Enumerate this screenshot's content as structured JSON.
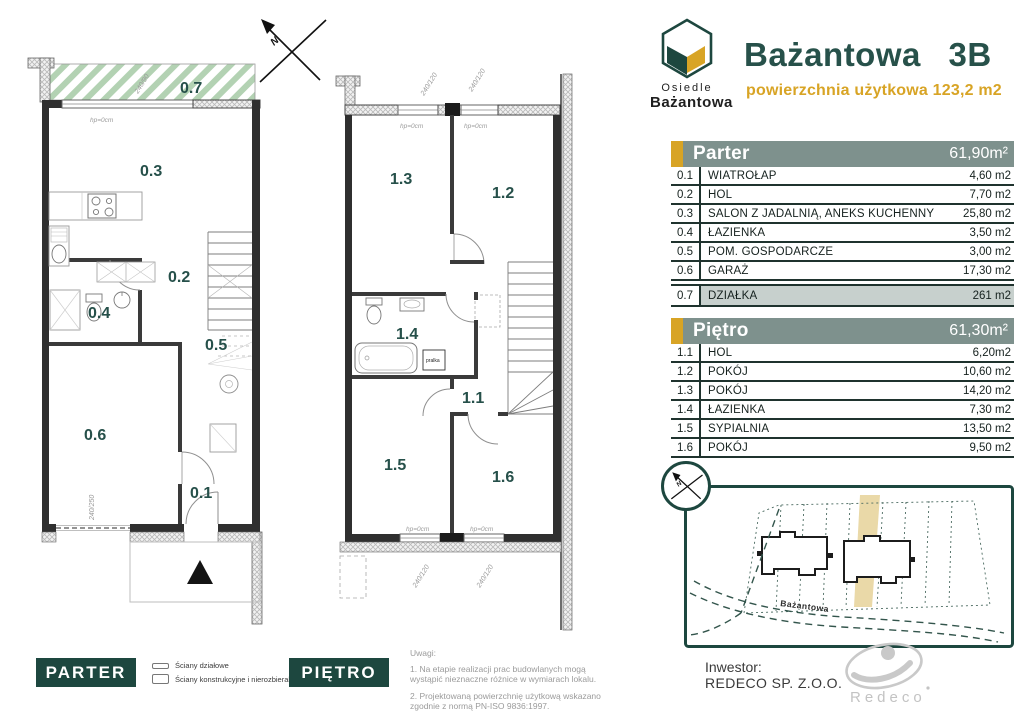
{
  "colors": {
    "dark_green": "#27514a",
    "badge_green": "#1d473f",
    "gold": "#d8a425",
    "table_header_bg": "#7e918d",
    "dzialka_row_bg": "#c7d0cd",
    "hatch_green": "#b3d2b3",
    "plot_highlight": "#ead9a8",
    "logo_gray": "#c7c7c7"
  },
  "logo": {
    "estate_line1": "Osiedle",
    "estate_line2": "Bażantowa"
  },
  "header": {
    "title": "Bażantowa 3B",
    "subtitle": "powierzchnia użytkowa 123,2 m2"
  },
  "tables": {
    "parter": {
      "title": "Parter",
      "total_area": "61,90m²",
      "rows": [
        {
          "id": "0.1",
          "name": "WIATROŁAP",
          "area": "4,60 m2"
        },
        {
          "id": "0.2",
          "name": "HOL",
          "area": "7,70 m2"
        },
        {
          "id": "0.3",
          "name": "SALON Z JADALNIĄ, ANEKS KUCHENNY",
          "area": "25,80 m2"
        },
        {
          "id": "0.4",
          "name": "ŁAZIENKA",
          "area": "3,50 m2"
        },
        {
          "id": "0.5",
          "name": "POM. GOSPODARCZE",
          "area": "3,00 m2"
        },
        {
          "id": "0.6",
          "name": "GARAŻ",
          "area": "17,30 m2"
        }
      ]
    },
    "dzialka": {
      "id": "0.7",
      "name": "DZIAŁKA",
      "area": "261 m2"
    },
    "pietro": {
      "title": "Piętro",
      "total_area": "61,30m²",
      "rows": [
        {
          "id": "1.1",
          "name": "HOL",
          "area": "6,20m2"
        },
        {
          "id": "1.2",
          "name": "POKÓJ",
          "area": "10,60 m2"
        },
        {
          "id": "1.3",
          "name": "POKÓJ",
          "area": "14,20 m2"
        },
        {
          "id": "1.4",
          "name": "ŁAZIENKA",
          "area": "7,30 m2"
        },
        {
          "id": "1.5",
          "name": "SYPIALNIA",
          "area": "13,50 m2"
        },
        {
          "id": "1.6",
          "name": "POKÓJ",
          "area": "9,50 m2"
        }
      ]
    }
  },
  "floorplans": {
    "parter_labels": {
      "r1": "0.1",
      "r2": "0.2",
      "r3": "0.3",
      "r4": "0.4",
      "r5": "0.5",
      "r6": "0.6",
      "terrace": "0.7"
    },
    "pietro_labels": {
      "r1": "1.1",
      "r2": "1.2",
      "r3": "1.3",
      "r4": "1.4",
      "r5": "1.5",
      "r6": "1.6"
    },
    "dims": {
      "terrace_window": "240/90",
      "garage_door": "240/250",
      "window": "240/120",
      "sill": "hp=0cm",
      "washer": "pralka",
      "north": "N"
    }
  },
  "siteplan": {
    "street": "Bażantowa"
  },
  "investor": {
    "label": "Inwestor:",
    "name": "REDECO SP. Z.O.O.",
    "logo_text": "Redeco"
  },
  "footer": {
    "parter_badge": "PARTER",
    "pietro_badge": "PIĘTRO",
    "legend": [
      {
        "label": "Ściany działowe"
      },
      {
        "label": "Ściany konstrukcyjne i nierozbieralne"
      }
    ],
    "notes_title": "Uwagi:",
    "notes": [
      {
        "text": "1. Na etapie realizacji prac budowlanych mogą wystąpić nieznaczne różnice w wymiarach lokalu."
      },
      {
        "text": "2. Projektowaną powierzchnię użytkową wskazano zgodnie z normą PN-ISO 9836:1997."
      }
    ]
  }
}
